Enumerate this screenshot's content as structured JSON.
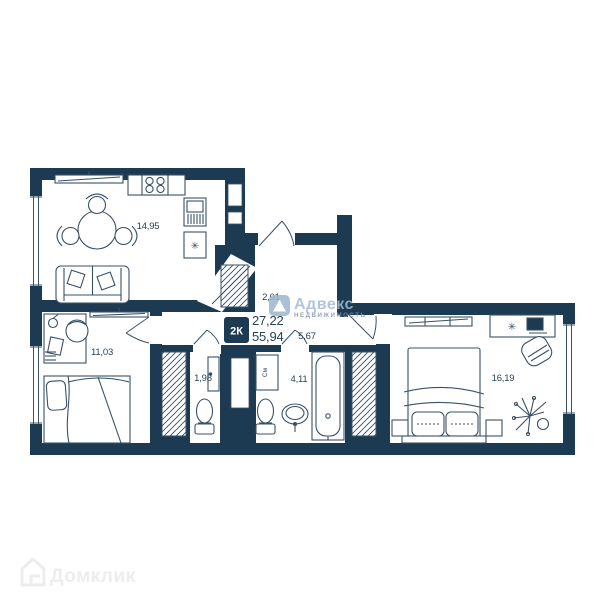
{
  "plan": {
    "type_badge": "2К",
    "living_area": "27,22",
    "total_area": "55,94",
    "rooms": [
      {
        "id": "kitchen-living",
        "area": "14,95"
      },
      {
        "id": "bedroom-1",
        "area": "11,03"
      },
      {
        "id": "wc",
        "area": "1,98"
      },
      {
        "id": "bathroom",
        "area": "4,11"
      },
      {
        "id": "hallway",
        "area": "5,67"
      },
      {
        "id": "entry-hall",
        "area": "2,01"
      },
      {
        "id": "bedroom-2",
        "area": "16,19"
      }
    ],
    "labels": {
      "washing_machine": "См"
    },
    "symbols": {
      "fridge": "✳",
      "desk_plant": "✳"
    }
  },
  "watermarks": {
    "agency": {
      "title": "Адвекс",
      "subtitle": "НЕДВИЖИМОСТЬ"
    },
    "portal": {
      "title": "Домклик"
    }
  },
  "colors": {
    "background": "#ffffff",
    "wall": "#1c3a52",
    "furniture_line": "#3b5166",
    "label_text": "#27425a",
    "agency_watermark": "#a3bcd2",
    "portal_watermark": "#ededed"
  }
}
